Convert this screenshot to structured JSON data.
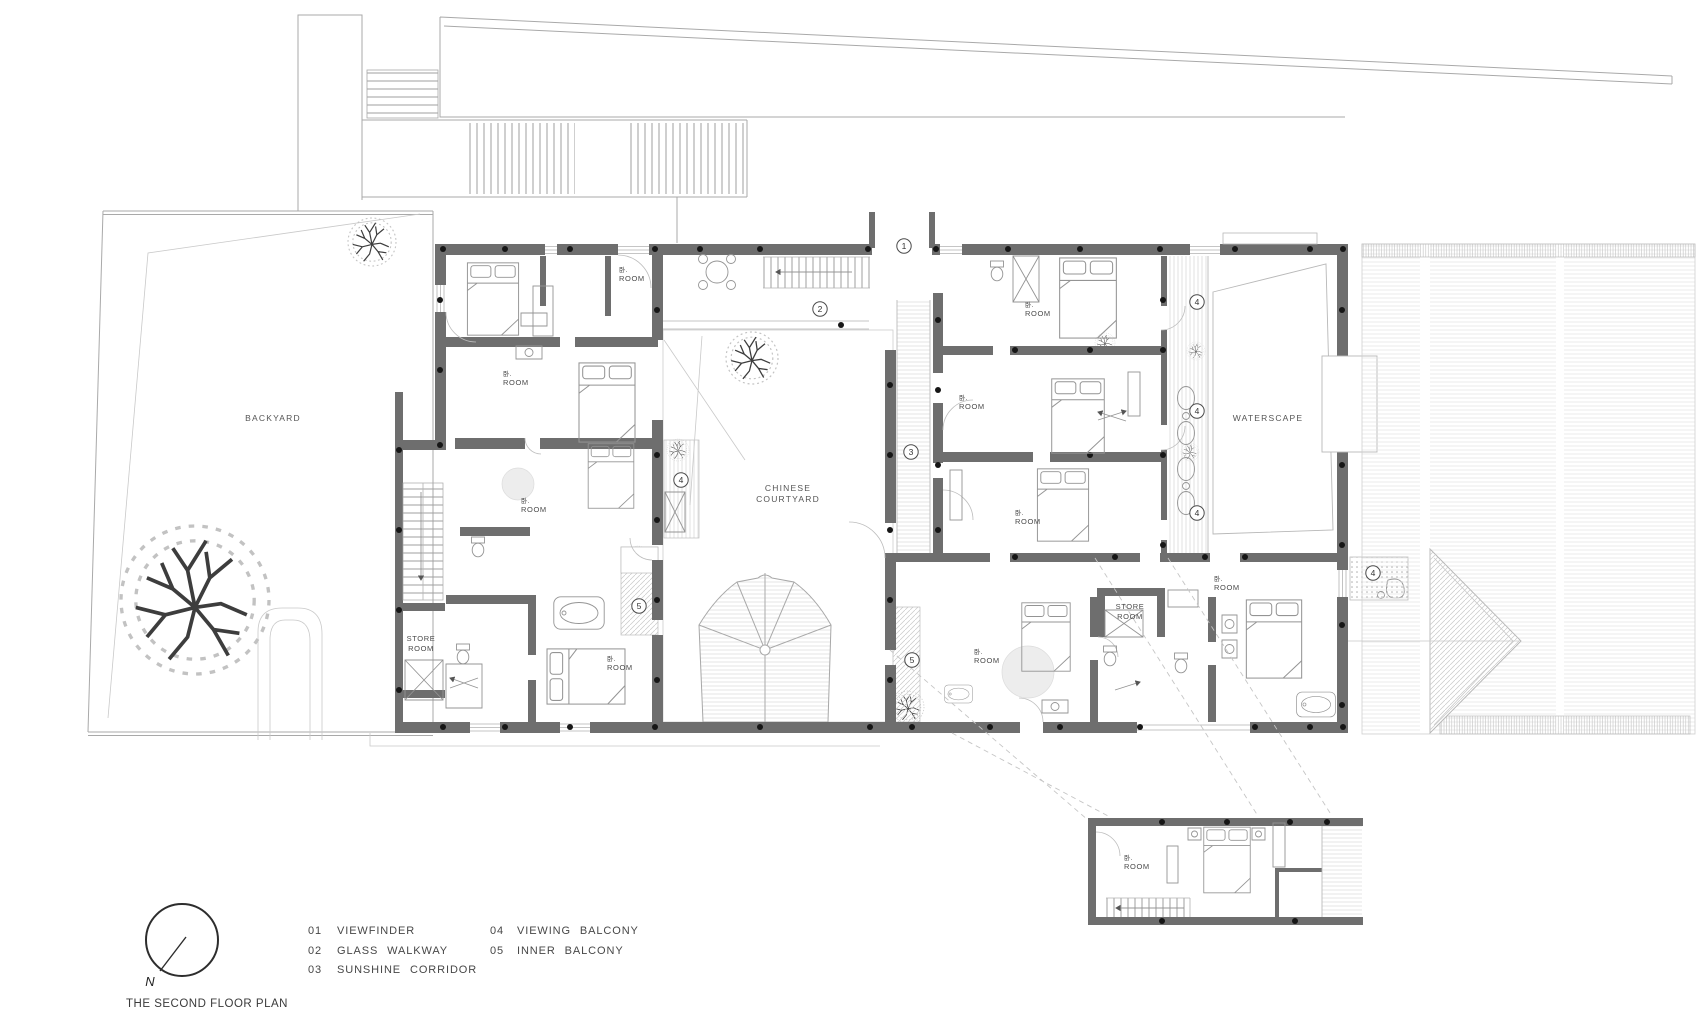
{
  "plan": {
    "title": "THE SECOND FLOOR PLAN",
    "compass_letter": "N",
    "colors": {
      "wall": "#6e6e6e",
      "line": "#ababab",
      "ink": "#4a4a4a"
    },
    "areas": {
      "backyard": "BACKYARD",
      "courtyard_line1": "CHINESE",
      "courtyard_line2": "COURTYARD",
      "waterscape": "WATERSCAPE",
      "store_line1": "STORE",
      "store_line2": "ROOM"
    },
    "room_label": {
      "prefix": "卧.",
      "name": "ROOM"
    },
    "markers": {
      "1": "1",
      "2": "2",
      "3": "3",
      "4": "4",
      "5": "5"
    },
    "legend": [
      {
        "num": "01",
        "label": "VIEWFINDER"
      },
      {
        "num": "02",
        "label": "GLASS WALKWAY"
      },
      {
        "num": "03",
        "label": "SUNSHINE CORRIDOR"
      },
      {
        "num": "04",
        "label": "VIEWING BALCONY"
      },
      {
        "num": "05",
        "label": "INNER BALCONY"
      }
    ]
  }
}
